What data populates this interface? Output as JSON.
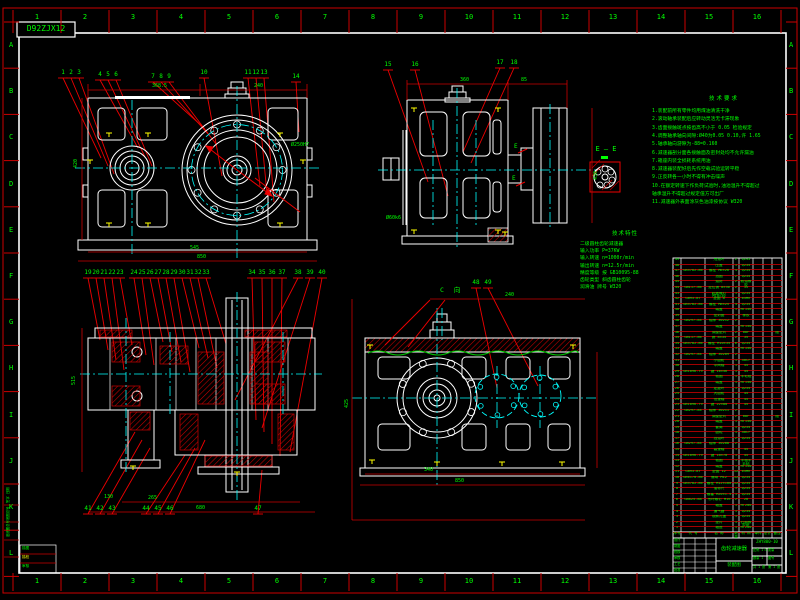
{
  "sheet": {
    "corner_code": "D92ZJX12",
    "zone_columns": [
      "1",
      "2",
      "3",
      "4",
      "5",
      "6",
      "7",
      "8",
      "9",
      "10",
      "11",
      "12",
      "13",
      "14",
      "15",
      "16"
    ],
    "zone_rows": [
      "A",
      "B",
      "C",
      "D",
      "E",
      "F",
      "G",
      "H",
      "I",
      "J",
      "K",
      "L"
    ]
  },
  "labels": {
    "section_ee": "E — E",
    "view_c": "C 向",
    "e_mark": "E"
  },
  "notes": {
    "title": "技术要求",
    "lines": [
      "1.装配前所有零件均用煤油清洗干净",
      "2.滚动轴承装配后应转动灵活无卡滞现象",
      "3.齿面接触斑点按齿高不小于 0.05 检验规定",
      "4.调整轴承轴向间隙:Ø40为0.05 0.10,许 1.65",
      "5.轴承轴向游隙为-88=0.160",
      "6.减速器剖分面各接触面及密封处均不允许漏油",
      "7.箱座内装全损耗系统用油",
      "8.减速器装配好后先作空载试验运转平稳",
      "9.正反转各一小时不得有冲击噪声",
      "10.在额定转速下作负荷试验时,油池温升不得超过",
      "   轴承温升不得超过规定值方可出厂",
      "11.减速器外表面涂灰色油漆按协议 W320"
    ]
  },
  "specs": {
    "title": "技术特性",
    "lines": [
      "二级圆柱齿轮减速器",
      "输入功率 P=37KW",
      "输入转速 n=1000r/min",
      "输出转速 n=12.5r/min",
      "精度等级 按 GB10095-88",
      "齿轮类型 斜齿圆柱齿轮",
      "润滑油 牌号 W320"
    ]
  },
  "balloons": {
    "front": [
      "1",
      "2",
      "3",
      "4",
      "5",
      "6",
      "7",
      "8",
      "9",
      "10",
      "11",
      "12",
      "13",
      "14"
    ],
    "side": [
      "15",
      "16",
      "17",
      "18"
    ],
    "section_top": [
      "19",
      "20",
      "21",
      "22",
      "23",
      "24",
      "25",
      "26",
      "27",
      "28",
      "29",
      "30",
      "31",
      "32",
      "33",
      "34",
      "35",
      "36",
      "37",
      "38",
      "39",
      "40"
    ],
    "section_bottom": [
      "41",
      "42",
      "43",
      "44",
      "45",
      "46",
      "47"
    ],
    "cview": [
      "48",
      "49"
    ]
  },
  "dims": {
    "front": [
      "368.5",
      "240",
      "545",
      "850",
      "Ø250H7",
      "420"
    ],
    "side": [
      "360",
      "85",
      "430",
      "Ø60k6"
    ],
    "section": [
      "515",
      "130",
      "265",
      "680"
    ],
    "view4": [
      "340",
      "850",
      "425",
      "240"
    ]
  },
  "bom": {
    "headers": [
      "序号",
      "代  号",
      "名  称",
      "数量",
      "材 料",
      "单件",
      "总计",
      "备注"
    ],
    "rows": [
      [
        "49",
        "",
        "甩油环",
        "2",
        "Q235",
        ""
      ],
      [
        "48",
        "",
        "压盖",
        "1",
        "Q235",
        ""
      ],
      [
        "47",
        "GB5782-86",
        "螺栓 M6×20",
        "4",
        "Q235",
        ""
      ],
      [
        "46",
        "",
        "挡圈",
        "2",
        "Q235",
        ""
      ],
      [
        "45",
        "",
        "油封",
        "2",
        "耐油橡胶",
        ""
      ],
      [
        "44",
        "GB117-86",
        "定位销 8×30",
        "2",
        "35",
        ""
      ],
      [
        "43",
        "",
        "起盖螺钉 M10×30",
        "1",
        "Q235",
        ""
      ],
      [
        "42",
        "GB93-87",
        "垫圈 8",
        "4",
        "65Mn",
        ""
      ],
      [
        "41",
        "GB5782-86",
        "螺栓 M8×25",
        "4",
        "Q235",
        ""
      ],
      [
        "40",
        "",
        "端盖",
        "1",
        "HT150",
        ""
      ],
      [
        "39",
        "",
        "密封圈",
        "1",
        "橡胶",
        ""
      ],
      [
        "38",
        "GB297-84",
        "轴承 30212",
        "2",
        "",
        ""
      ],
      [
        "37",
        "",
        "端盖",
        "1",
        "HT150",
        ""
      ],
      [
        "36",
        "",
        "调整垫片",
        "2",
        "08F",
        "组"
      ],
      [
        "35",
        "GB117-86",
        "销 8×35",
        "2",
        "35",
        ""
      ],
      [
        "34",
        "GB5782-86",
        "螺栓 M10×35",
        "6",
        "Q235",
        ""
      ],
      [
        "33",
        "",
        "端盖",
        "1",
        "HT150",
        ""
      ],
      [
        "32",
        "GB297-84",
        "轴承 30209",
        "2",
        "",
        ""
      ],
      [
        "31",
        "",
        "小齿轮",
        "1",
        "40Cr",
        ""
      ],
      [
        "30",
        "",
        "中间轴",
        "1",
        "45",
        ""
      ],
      [
        "29",
        "GB1096-79",
        "键 16×56",
        "1",
        "45",
        ""
      ],
      [
        "28",
        "",
        "毡圈",
        "1",
        "羊毛毡",
        ""
      ],
      [
        "27",
        "",
        "端盖",
        "1",
        "HT150",
        ""
      ],
      [
        "26",
        "",
        "定距环",
        "1",
        "Q235",
        ""
      ],
      [
        "25",
        "",
        "大齿轮",
        "1",
        "45",
        ""
      ],
      [
        "24",
        "",
        "低速轴",
        "1",
        "45",
        ""
      ],
      [
        "23",
        "GB1096-79",
        "键 22×80",
        "1",
        "45",
        ""
      ],
      [
        "22",
        "GB297-84",
        "轴承 30211",
        "2",
        "",
        ""
      ],
      [
        "21",
        "",
        "调整垫片",
        "2",
        "08F",
        "组"
      ],
      [
        "20",
        "",
        "端盖",
        "1",
        "HT150",
        ""
      ],
      [
        "19",
        "",
        "套筒",
        "1",
        "Q235",
        ""
      ],
      [
        "18",
        "",
        "齿轮",
        "1",
        "40Cr",
        ""
      ],
      [
        "17",
        "",
        "挡油环",
        "2",
        "Q235",
        ""
      ],
      [
        "16",
        "GB297-84",
        "轴承 30208",
        "2",
        "",
        ""
      ],
      [
        "15",
        "",
        "高速轴",
        "1",
        "45",
        ""
      ],
      [
        "14",
        "GB1096-79",
        "键 18×70",
        "1",
        "45",
        ""
      ],
      [
        "13",
        "",
        "毡圈",
        "1",
        "半粗羊毛毡",
        ""
      ],
      [
        "12",
        "",
        "端盖",
        "1",
        "HT150",
        ""
      ],
      [
        "11",
        "GB93-87",
        "垫圈 12",
        "12",
        "65Mn",
        ""
      ],
      [
        "10",
        "GB6170-86",
        "螺母 M12",
        "12",
        "Q235",
        ""
      ],
      [
        "9",
        "GB5782-86",
        "螺栓 M12×100",
        "12",
        "Q235",
        ""
      ],
      [
        "8",
        "",
        "油标尺",
        "1",
        "Q235",
        ""
      ],
      [
        "7",
        "",
        "螺塞 M20×1.5",
        "1",
        "Q235",
        ""
      ],
      [
        "6",
        "GB825-88",
        "吊环螺钉 M16",
        "2",
        "20",
        ""
      ],
      [
        "5",
        "",
        "箱盖",
        "1",
        "HT200",
        ""
      ],
      [
        "4",
        "",
        "通气器",
        "1",
        "Q235",
        ""
      ],
      [
        "3",
        "",
        "观察孔盖",
        "1",
        "Q235",
        ""
      ],
      [
        "2",
        "",
        "垫片",
        "1",
        "石棉橡胶纸",
        ""
      ],
      [
        "1",
        "",
        "箱座",
        "1",
        "HT200",
        ""
      ]
    ]
  },
  "title_block": {
    "name": "齿轮减速器",
    "type": "装配图",
    "code": "ZHY800-10",
    "sig_rows": [
      "设计",
      "制图",
      "校核",
      "审核",
      "工艺",
      "批准"
    ],
    "sig_cols": [
      "签字",
      "日期"
    ],
    "cells": [
      "比例 1:5",
      "质量",
      "数量 1",
      "共 1 张",
      "第 1 张",
      "图号"
    ]
  },
  "margin_block": {
    "side_rows": [
      "旧底图总号",
      "底图总号",
      "签字 日期"
    ],
    "corner_rows": [
      "描图",
      "描校",
      "审核"
    ]
  }
}
